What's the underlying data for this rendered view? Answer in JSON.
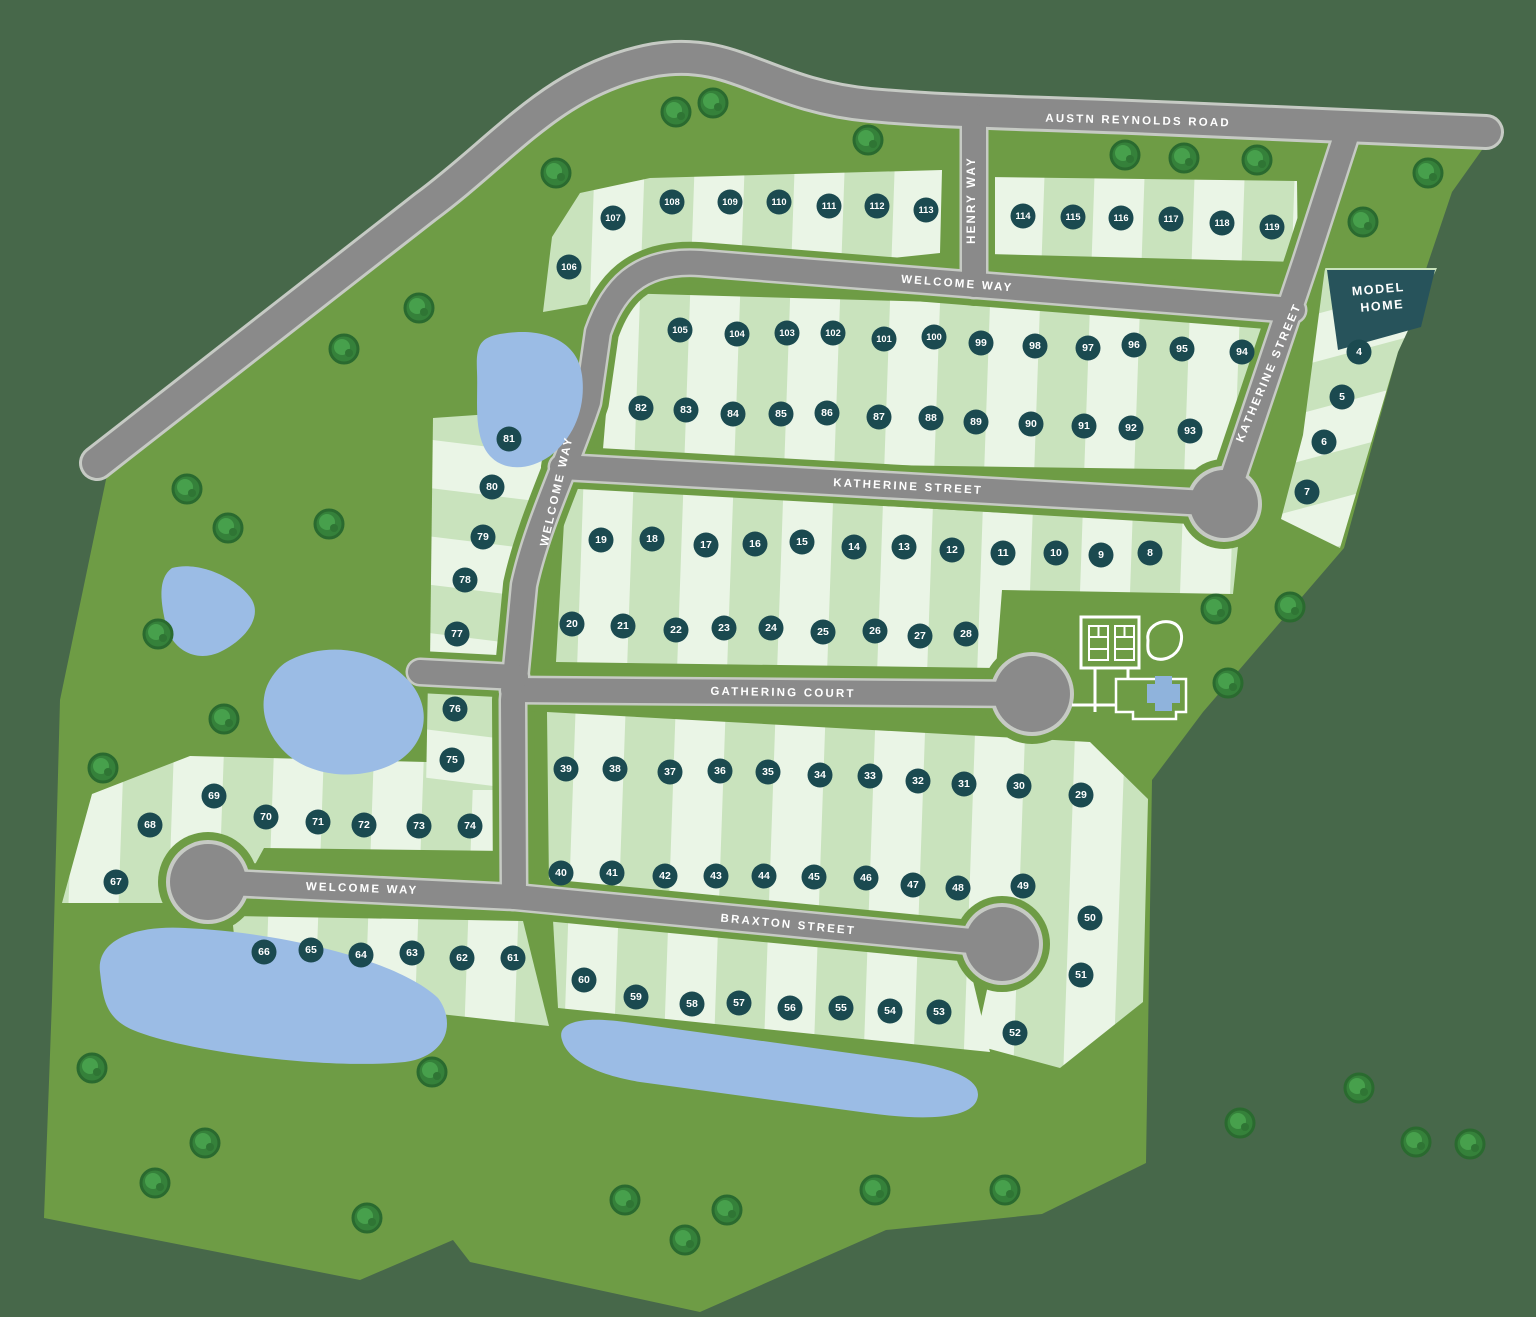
{
  "map_title": "Community Site Plan",
  "streets": [
    {
      "id": "austin-reynolds-road",
      "label": "AUSTN REYNOLDS ROAD"
    },
    {
      "id": "henry-way",
      "label": "HENRY WAY"
    },
    {
      "id": "welcome-way-upper",
      "label": "WELCOME WAY"
    },
    {
      "id": "welcome-way-diagonal",
      "label": "WELCOME WAY"
    },
    {
      "id": "katherine-street-horizontal",
      "label": "KATHERINE STREET"
    },
    {
      "id": "katherine-street-diagonal",
      "label": "KATHERINE STREET"
    },
    {
      "id": "gathering-court",
      "label": "GATHERING COURT"
    },
    {
      "id": "welcome-way-lower",
      "label": "WELCOME WAY"
    },
    {
      "id": "braxton-street",
      "label": "BRAXTON STREET"
    }
  ],
  "model_home": {
    "line1": "MODEL",
    "line2": "HOME"
  },
  "colors": {
    "outer_green": "#47684A",
    "parcel_green": "#6E9C45",
    "lot_light": "#EAF5E6",
    "lot_green": "#C9E3BD",
    "road_gray": "#8A8A8A",
    "road_edge": "#C6CAC4",
    "marker_teal": "#1B4A50",
    "model_teal": "#27535B",
    "pond_blue": "#9BBCE5",
    "tree_green": "#35813A",
    "label_white": "#FFFFFF"
  },
  "lots": [
    {
      "n": 4,
      "x": 1359,
      "y": 352
    },
    {
      "n": 5,
      "x": 1342,
      "y": 397
    },
    {
      "n": 6,
      "x": 1324,
      "y": 442
    },
    {
      "n": 7,
      "x": 1307,
      "y": 492
    },
    {
      "n": 8,
      "x": 1150,
      "y": 553
    },
    {
      "n": 9,
      "x": 1101,
      "y": 555
    },
    {
      "n": 10,
      "x": 1056,
      "y": 553
    },
    {
      "n": 11,
      "x": 1003,
      "y": 553
    },
    {
      "n": 12,
      "x": 952,
      "y": 550
    },
    {
      "n": 13,
      "x": 904,
      "y": 547
    },
    {
      "n": 14,
      "x": 854,
      "y": 547
    },
    {
      "n": 15,
      "x": 802,
      "y": 542
    },
    {
      "n": 16,
      "x": 755,
      "y": 544
    },
    {
      "n": 17,
      "x": 706,
      "y": 545
    },
    {
      "n": 18,
      "x": 652,
      "y": 539
    },
    {
      "n": 19,
      "x": 601,
      "y": 540
    },
    {
      "n": 20,
      "x": 572,
      "y": 624
    },
    {
      "n": 21,
      "x": 623,
      "y": 626
    },
    {
      "n": 22,
      "x": 676,
      "y": 630
    },
    {
      "n": 23,
      "x": 724,
      "y": 628
    },
    {
      "n": 24,
      "x": 771,
      "y": 628
    },
    {
      "n": 25,
      "x": 823,
      "y": 632
    },
    {
      "n": 26,
      "x": 875,
      "y": 631
    },
    {
      "n": 27,
      "x": 920,
      "y": 636
    },
    {
      "n": 28,
      "x": 966,
      "y": 634
    },
    {
      "n": 29,
      "x": 1081,
      "y": 795
    },
    {
      "n": 30,
      "x": 1019,
      "y": 786
    },
    {
      "n": 31,
      "x": 964,
      "y": 784
    },
    {
      "n": 32,
      "x": 918,
      "y": 781
    },
    {
      "n": 33,
      "x": 870,
      "y": 776
    },
    {
      "n": 34,
      "x": 820,
      "y": 775
    },
    {
      "n": 35,
      "x": 768,
      "y": 772
    },
    {
      "n": 36,
      "x": 720,
      "y": 771
    },
    {
      "n": 37,
      "x": 670,
      "y": 772
    },
    {
      "n": 38,
      "x": 615,
      "y": 769
    },
    {
      "n": 39,
      "x": 566,
      "y": 769
    },
    {
      "n": 40,
      "x": 561,
      "y": 873
    },
    {
      "n": 41,
      "x": 612,
      "y": 873
    },
    {
      "n": 42,
      "x": 665,
      "y": 876
    },
    {
      "n": 43,
      "x": 716,
      "y": 876
    },
    {
      "n": 44,
      "x": 764,
      "y": 876
    },
    {
      "n": 45,
      "x": 814,
      "y": 877
    },
    {
      "n": 46,
      "x": 866,
      "y": 878
    },
    {
      "n": 47,
      "x": 913,
      "y": 885
    },
    {
      "n": 48,
      "x": 958,
      "y": 888
    },
    {
      "n": 49,
      "x": 1023,
      "y": 886
    },
    {
      "n": 50,
      "x": 1090,
      "y": 918
    },
    {
      "n": 51,
      "x": 1081,
      "y": 975
    },
    {
      "n": 52,
      "x": 1015,
      "y": 1033
    },
    {
      "n": 53,
      "x": 939,
      "y": 1012
    },
    {
      "n": 54,
      "x": 890,
      "y": 1011
    },
    {
      "n": 55,
      "x": 841,
      "y": 1008
    },
    {
      "n": 56,
      "x": 790,
      "y": 1008
    },
    {
      "n": 57,
      "x": 739,
      "y": 1003
    },
    {
      "n": 58,
      "x": 692,
      "y": 1004
    },
    {
      "n": 59,
      "x": 636,
      "y": 997
    },
    {
      "n": 60,
      "x": 584,
      "y": 980
    },
    {
      "n": 61,
      "x": 513,
      "y": 958
    },
    {
      "n": 62,
      "x": 462,
      "y": 958
    },
    {
      "n": 63,
      "x": 412,
      "y": 953
    },
    {
      "n": 64,
      "x": 361,
      "y": 955
    },
    {
      "n": 65,
      "x": 311,
      "y": 950
    },
    {
      "n": 66,
      "x": 264,
      "y": 952
    },
    {
      "n": 67,
      "x": 116,
      "y": 882
    },
    {
      "n": 68,
      "x": 150,
      "y": 825
    },
    {
      "n": 69,
      "x": 214,
      "y": 796
    },
    {
      "n": 70,
      "x": 266,
      "y": 817
    },
    {
      "n": 71,
      "x": 318,
      "y": 822
    },
    {
      "n": 72,
      "x": 364,
      "y": 825
    },
    {
      "n": 73,
      "x": 419,
      "y": 826
    },
    {
      "n": 74,
      "x": 470,
      "y": 826
    },
    {
      "n": 75,
      "x": 452,
      "y": 760
    },
    {
      "n": 76,
      "x": 455,
      "y": 709
    },
    {
      "n": 77,
      "x": 457,
      "y": 634
    },
    {
      "n": 78,
      "x": 465,
      "y": 580
    },
    {
      "n": 79,
      "x": 483,
      "y": 537
    },
    {
      "n": 80,
      "x": 492,
      "y": 487
    },
    {
      "n": 81,
      "x": 509,
      "y": 439
    },
    {
      "n": 82,
      "x": 641,
      "y": 408
    },
    {
      "n": 83,
      "x": 686,
      "y": 410
    },
    {
      "n": 84,
      "x": 733,
      "y": 414
    },
    {
      "n": 85,
      "x": 781,
      "y": 414
    },
    {
      "n": 86,
      "x": 827,
      "y": 413
    },
    {
      "n": 87,
      "x": 879,
      "y": 417
    },
    {
      "n": 88,
      "x": 931,
      "y": 418
    },
    {
      "n": 89,
      "x": 976,
      "y": 422
    },
    {
      "n": 90,
      "x": 1031,
      "y": 424
    },
    {
      "n": 91,
      "x": 1084,
      "y": 426
    },
    {
      "n": 92,
      "x": 1131,
      "y": 428
    },
    {
      "n": 93,
      "x": 1190,
      "y": 431
    },
    {
      "n": 94,
      "x": 1242,
      "y": 352
    },
    {
      "n": 95,
      "x": 1182,
      "y": 349
    },
    {
      "n": 96,
      "x": 1134,
      "y": 345
    },
    {
      "n": 97,
      "x": 1088,
      "y": 348
    },
    {
      "n": 98,
      "x": 1035,
      "y": 346
    },
    {
      "n": 99,
      "x": 981,
      "y": 343
    },
    {
      "n": 100,
      "x": 934,
      "y": 337
    },
    {
      "n": 101,
      "x": 884,
      "y": 339
    },
    {
      "n": 102,
      "x": 833,
      "y": 333
    },
    {
      "n": 103,
      "x": 787,
      "y": 333
    },
    {
      "n": 104,
      "x": 737,
      "y": 334
    },
    {
      "n": 105,
      "x": 680,
      "y": 330
    },
    {
      "n": 106,
      "x": 569,
      "y": 267
    },
    {
      "n": 107,
      "x": 613,
      "y": 218
    },
    {
      "n": 108,
      "x": 672,
      "y": 202
    },
    {
      "n": 109,
      "x": 730,
      "y": 202
    },
    {
      "n": 110,
      "x": 779,
      "y": 202
    },
    {
      "n": 111,
      "x": 829,
      "y": 206
    },
    {
      "n": 112,
      "x": 877,
      "y": 206
    },
    {
      "n": 113,
      "x": 926,
      "y": 210
    },
    {
      "n": 114,
      "x": 1023,
      "y": 216
    },
    {
      "n": 115,
      "x": 1073,
      "y": 217
    },
    {
      "n": 116,
      "x": 1121,
      "y": 218
    },
    {
      "n": 117,
      "x": 1171,
      "y": 219
    },
    {
      "n": 118,
      "x": 1222,
      "y": 223
    },
    {
      "n": 119,
      "x": 1272,
      "y": 227
    }
  ],
  "amenities": [
    {
      "id": "sport-courts",
      "label": "courts"
    },
    {
      "id": "clubhouse-pool",
      "label": "pool"
    }
  ]
}
